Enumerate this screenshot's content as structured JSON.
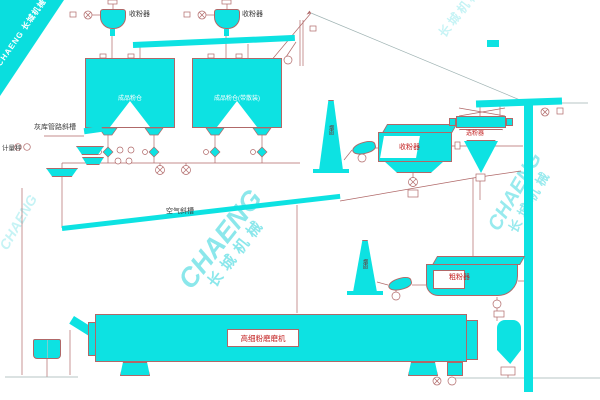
{
  "watermark": {
    "brand": "CHAENG",
    "brand_cn": "长城机械"
  },
  "labels": {
    "dust_collector_1": "收粉器",
    "dust_collector_2": "收粉器",
    "silo_1": "成品粉仓",
    "silo_2": "成品粉仓(带散装)",
    "left_chute": "灰库管路斜槽",
    "weigher": "计量秤",
    "air_slide": "空气斜槽",
    "stack_upper": "烟囱",
    "stack_lower": "烟囱",
    "bag_filter": "收粉器",
    "separator": "选粉器",
    "coarse_collector": "粗粉器",
    "mill": "高细粉磨磨机"
  },
  "colors": {
    "equipment": "#0de2e2",
    "pipe_line": "#b06868",
    "label_red": "#c32222",
    "watermark": "#00ccd5"
  }
}
